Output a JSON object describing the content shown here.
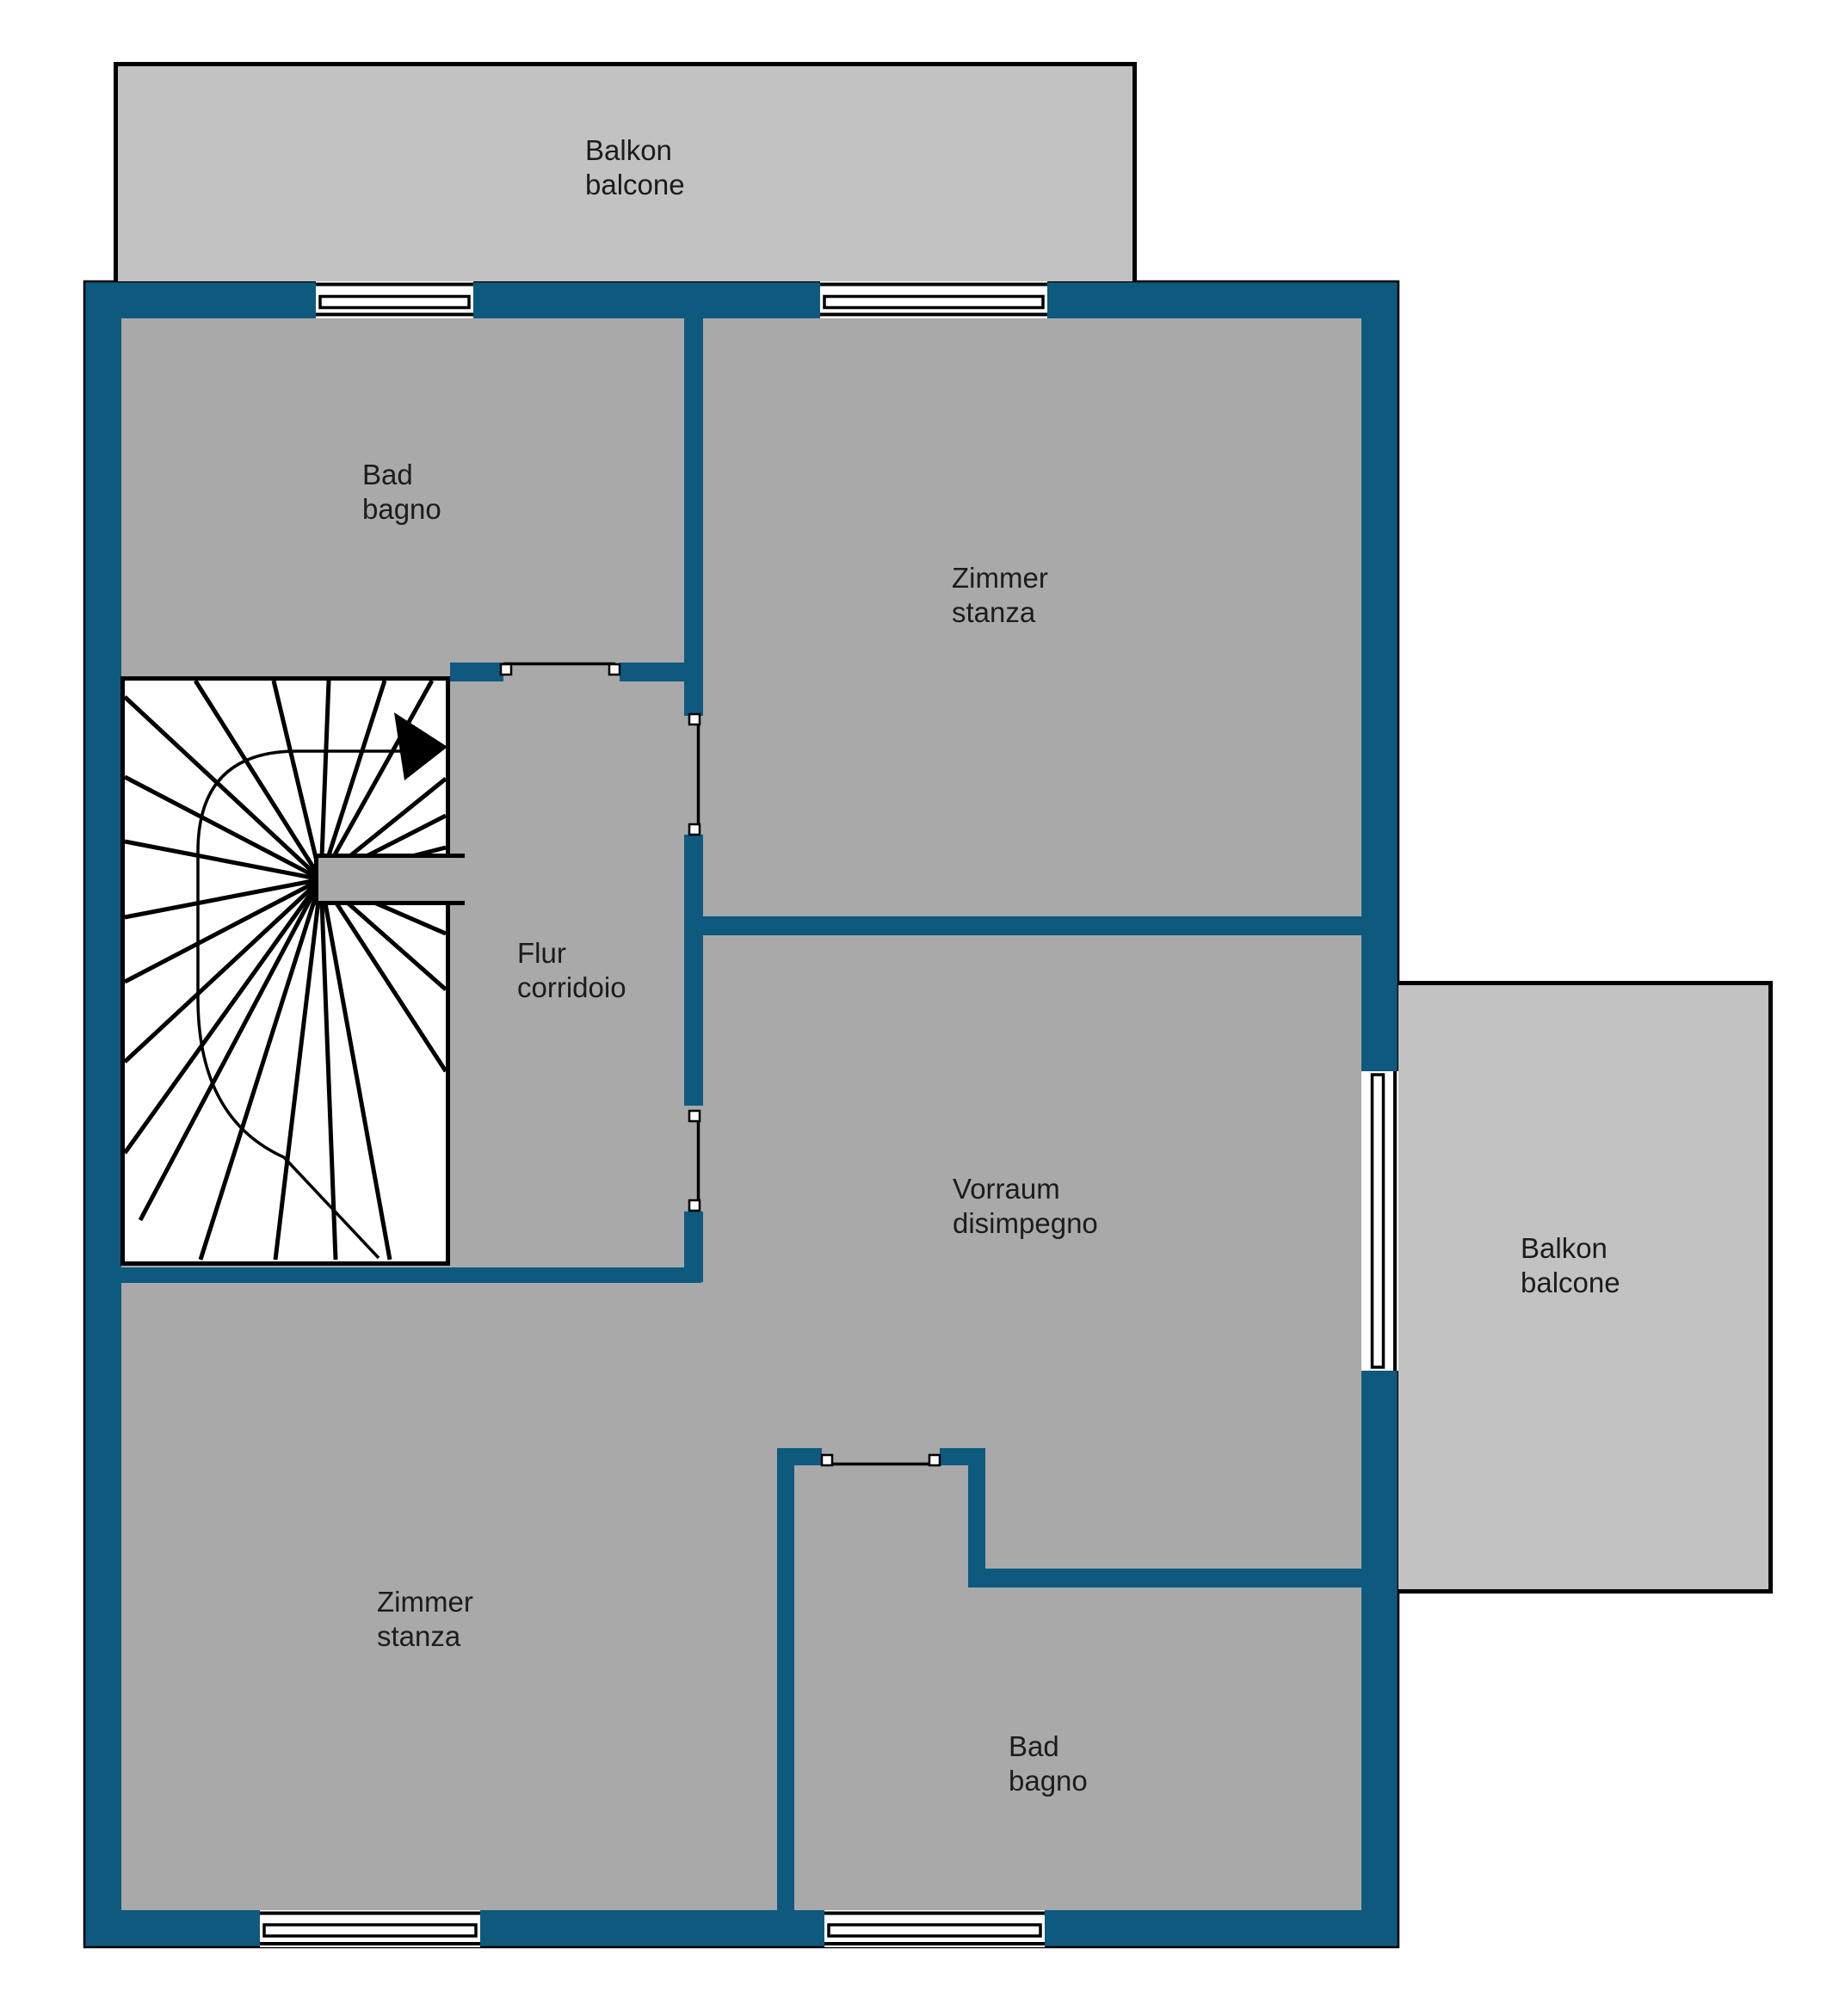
{
  "plan": {
    "type": "floor-plan",
    "floor_labels_language": "German / Italian"
  },
  "colors": {
    "wall": "#0d5a7e",
    "room": "#a9a9a9",
    "balcony": "#c2c2c2",
    "white": "#ffffff",
    "outline": "#000000",
    "text": "#1c1c1c"
  },
  "rooms": {
    "balkon_top": {
      "line1": "Balkon",
      "line2": "balcone"
    },
    "bad_top": {
      "line1": "Bad",
      "line2": "bagno"
    },
    "zimmer_top": {
      "line1": "Zimmer",
      "line2": "stanza"
    },
    "flur": {
      "line1": "Flur",
      "line2": "corridoio"
    },
    "vorraum": {
      "line1": "Vorraum",
      "line2": "disimpegno"
    },
    "balkon_right": {
      "line1": "Balkon",
      "line2": "balcone"
    },
    "zimmer_bottom": {
      "line1": "Zimmer",
      "line2": "stanza"
    },
    "bad_bottom": {
      "line1": "Bad",
      "line2": "bagno"
    }
  },
  "icons": {
    "stair_direction_arrow": "right-pointing solid triangle",
    "window_symbol": "white opening with double-line mullion",
    "door_symbol": "thin line opening with jamb blocks"
  }
}
